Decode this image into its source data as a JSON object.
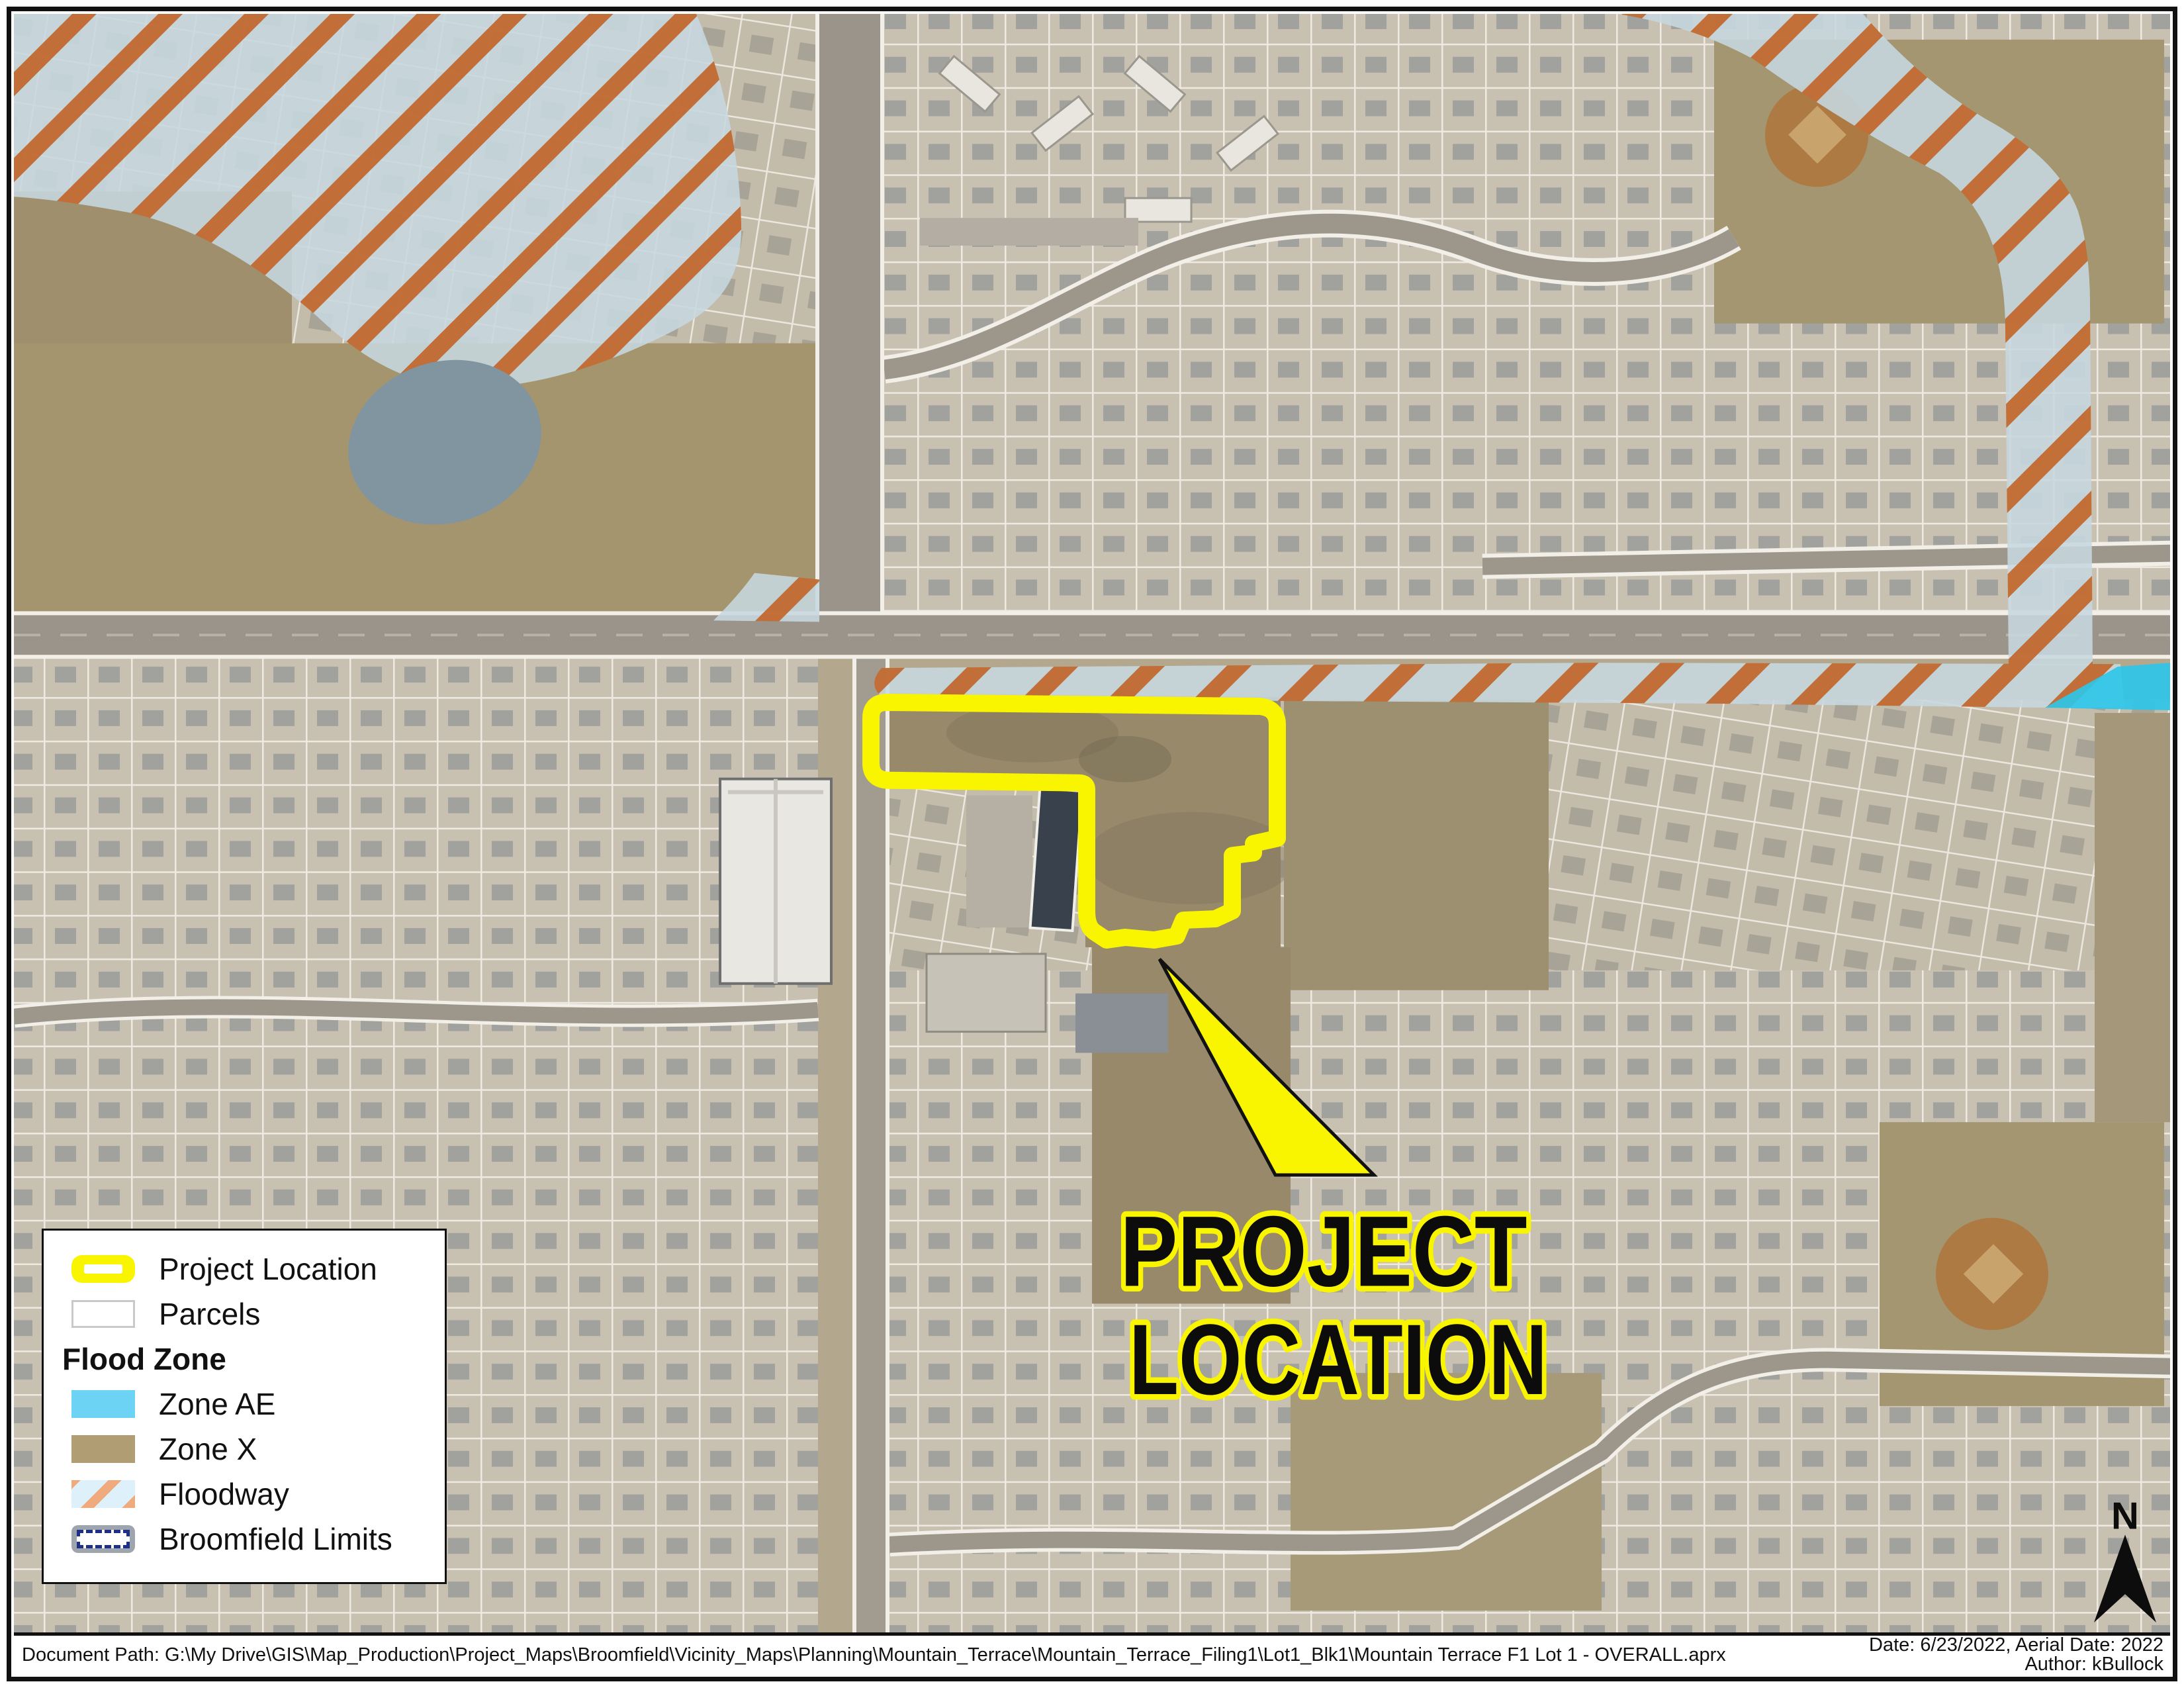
{
  "map": {
    "callout_label_line1": "PROJECT",
    "callout_label_line2": "LOCATION",
    "north_label": "N",
    "overlays": {
      "project_boundary_color": "#f9f500",
      "floodway_stripe_color": "#c2662c",
      "floodway_fill_color": "#c7d8e0",
      "zone_ae_color": "#2fc5e9",
      "zone_x_color": "#b09d73"
    }
  },
  "legend": {
    "items": [
      {
        "label": "Project Location",
        "type": "project-location-symbol"
      },
      {
        "label": "Parcels",
        "type": "parcels-symbol"
      },
      {
        "label": "Flood Zone",
        "type": "section-header"
      },
      {
        "label": "Zone AE",
        "type": "zone-ae-swatch",
        "color": "#6cd3f4"
      },
      {
        "label": "Zone X",
        "type": "zone-x-swatch",
        "color": "#b09d73"
      },
      {
        "label": "Floodway",
        "type": "floodway-swatch"
      },
      {
        "label": "Broomfield Limits",
        "type": "broomfield-limits-symbol"
      }
    ]
  },
  "footer": {
    "document_path": "Document Path: G:\\My Drive\\GIS\\Map_Production\\Project_Maps\\Broomfield\\Vicinity_Maps\\Planning\\Mountain_Terrace\\Mountain_Terrace_Filing1\\Lot1_Blk1\\Mountain Terrace F1 Lot 1 - OVERALL.aprx",
    "date_line": "Date: 6/23/2022, Aerial Date: 2022",
    "author_line": "Author: kBullock"
  }
}
